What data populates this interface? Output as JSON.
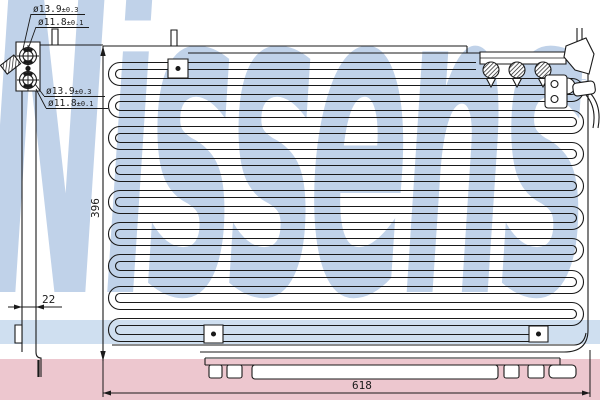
{
  "watermark": {
    "text": "Nissens",
    "registered_mark": "®"
  },
  "diagram": {
    "dimension_labels": {
      "height": "396",
      "depth": "22",
      "width": "618"
    },
    "port_labels": {
      "top_outer_diameter": "ø13.9",
      "top_outer_tolerance": "±0.3",
      "top_inner_diameter": "ø11.8",
      "top_inner_tolerance": "±0.1",
      "bottom_outer_diameter": "ø13.9",
      "bottom_outer_tolerance": "±0.3",
      "bottom_inner_diameter": "ø11.8",
      "bottom_inner_tolerance": "±0.1"
    }
  },
  "colors": {
    "watermark_blue": "#c0d2e9",
    "stripe_blue": "#cfdff0",
    "stripe_pink": "#edc7cf",
    "line": "#1a1a1a"
  }
}
